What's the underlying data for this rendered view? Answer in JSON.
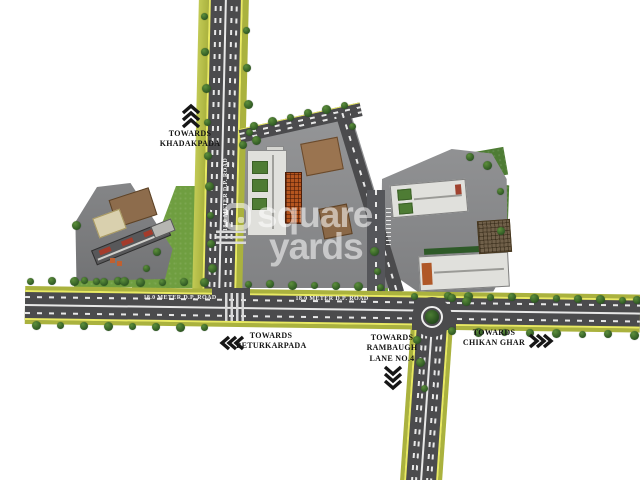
{
  "map": {
    "watermark": {
      "line1": "square",
      "line2": "yards"
    },
    "road_label": "18.0 METER D.P. ROAD",
    "directions": {
      "khadakpada": {
        "towards": "TOWARDS",
        "name": "KHADAKPADA",
        "arrow": "up"
      },
      "beturkarpada": {
        "towards": "TOWARDS",
        "name": "BETURKARPADA",
        "arrow": "left"
      },
      "rambaugh": {
        "towards": "TOWARDS",
        "name": "RAMBAUGH",
        "name2": "LANE NO.4",
        "arrow": "down"
      },
      "chikan_ghar": {
        "towards": "TOWARDS",
        "name": "CHIKAN GHAR",
        "arrow": "right"
      }
    }
  },
  "colors": {
    "road": "#4b4b4d",
    "edge-yellow": "#e9ea62",
    "edge-olive": "#aab23e",
    "lane": "#e8e8e8",
    "grass": "#6f9e40",
    "grass-dark": "#4e7c34",
    "plot-left": "#7d7e80",
    "plot-mid": "#8e8f91",
    "plot-right": "#8a8b8d",
    "building-white": "#e0e0dc",
    "building-orange": "#b5551f",
    "building-brown": "#97724d",
    "tree-dark": "#2c5522",
    "tree-light": "#5d8f3c",
    "label-text": "#141414",
    "watermark": "#ffffff"
  }
}
